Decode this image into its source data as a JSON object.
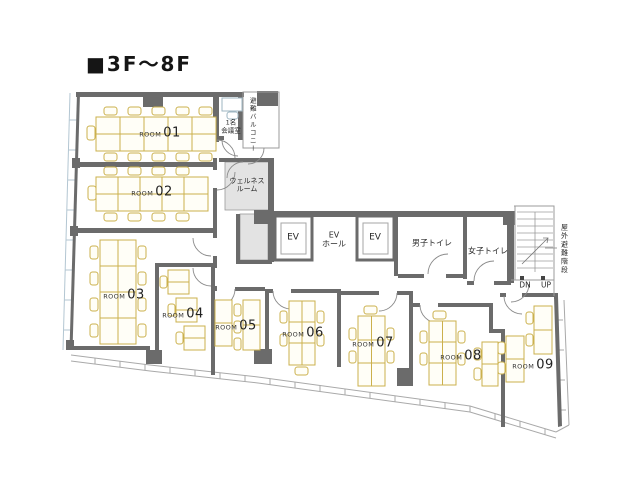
{
  "title": "■3F～8F",
  "colors": {
    "wall": "#6b6b6b",
    "thin_line": "#9b9b9b",
    "furniture": "#cbb04c",
    "shade_fill": "#e3e3e3",
    "glass_line": "#b3c6d2",
    "text": "#2a2a2a"
  },
  "rooms": [
    {
      "label": "ROOM",
      "number": "01"
    },
    {
      "label": "ROOM",
      "number": "02"
    },
    {
      "label": "ROOM",
      "number": "03"
    },
    {
      "label": "ROOM",
      "number": "04"
    },
    {
      "label": "ROOM",
      "number": "05"
    },
    {
      "label": "ROOM",
      "number": "06"
    },
    {
      "label": "ROOM",
      "number": "07"
    },
    {
      "label": "ROOM",
      "number": "08"
    },
    {
      "label": "ROOM",
      "number": "09"
    }
  ],
  "facilities": {
    "meeting_room": "1名\n会議室",
    "balcony": "避難バルコニー",
    "wellness_room": "ウェルネス\nルーム",
    "elevator_left": "EV",
    "elevator_right": "EV",
    "ev_hall": "EV\nホール",
    "mens_toilet": "男子トイレ",
    "womens_toilet": "女子トイレ",
    "outdoor_stair": "屋外避難階段",
    "stair_down": "DN",
    "stair_up": "UP"
  }
}
